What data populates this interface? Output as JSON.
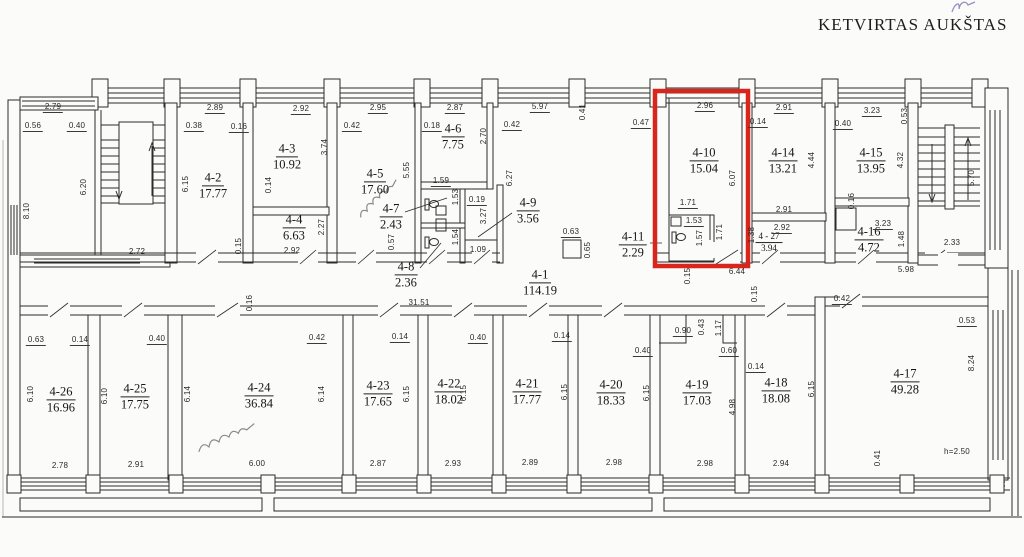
{
  "title": "KETVIRTAS AUKŠTAS",
  "highlight_color": "#d9261c",
  "rooms": {
    "r4_1": {
      "id": "4-1",
      "area": "114.19"
    },
    "r4_2": {
      "id": "4-2",
      "area": "17.77"
    },
    "r4_3": {
      "id": "4-3",
      "area": "10.92"
    },
    "r4_4": {
      "id": "4-4",
      "area": "6.63"
    },
    "r4_5": {
      "id": "4-5",
      "area": "17.60"
    },
    "r4_6": {
      "id": "4-6",
      "area": "7.75"
    },
    "r4_7": {
      "id": "4-7",
      "area": "2.43"
    },
    "r4_8": {
      "id": "4-8",
      "area": "2.36"
    },
    "r4_9": {
      "id": "4-9",
      "area": "3.56"
    },
    "r4_10": {
      "id": "4-10",
      "area": "15.04"
    },
    "r4_11": {
      "id": "4-11",
      "area": "2.29"
    },
    "r4_14": {
      "id": "4-14",
      "area": "13.21"
    },
    "r4_15": {
      "id": "4-15",
      "area": "13.95"
    },
    "r4_16": {
      "id": "4-16",
      "area": "4.72"
    },
    "r4_17": {
      "id": "4-17",
      "area": "49.28"
    },
    "r4_18": {
      "id": "4-18",
      "area": "18.08"
    },
    "r4_19": {
      "id": "4-19",
      "area": "17.03"
    },
    "r4_20": {
      "id": "4-20",
      "area": "18.33"
    },
    "r4_21": {
      "id": "4-21",
      "area": "17.77"
    },
    "r4_22": {
      "id": "4-22",
      "area": "18.02"
    },
    "r4_23": {
      "id": "4-23",
      "area": "17.65"
    },
    "r4_24": {
      "id": "4-24",
      "area": "36.84"
    },
    "r4_25": {
      "id": "4-25",
      "area": "17.75"
    },
    "r4_26": {
      "id": "4-26",
      "area": "16.96"
    },
    "r4_27": {
      "id": "4 - 27",
      "area": "3.94"
    }
  },
  "dims": {
    "sl_top": "2.79",
    "sl_a": "0.56",
    "sl_b": "0.40",
    "sl_h": "6.20",
    "ext_l": "8.10",
    "sl_bot": "2.72",
    "r2_top": "2.89",
    "r2_a": "0.38",
    "r2_b": "0.16",
    "r2_h": "6.15",
    "r2_c": "0.15",
    "r3_top": "2.92",
    "r3_h": "3.74",
    "r3_a": "0.14",
    "r4_h": "2.27",
    "r4_bot": "2.92",
    "r5_top": "2.95",
    "r5_a": "0.42",
    "r5_h": "5.55",
    "r5_b": "0.57",
    "r6_top": "2.87",
    "r6_a": "0.18",
    "r6_b": "0.42",
    "r6_h": "2.70",
    "hall_top": "5.97",
    "col_a": "0.41",
    "wc_a": "1.59",
    "wc_b": "1.53",
    "wc_c": "0.19",
    "wc_d": "3.27",
    "wc_e": "1.54",
    "wc_f": "1.09",
    "open_h": "6.27",
    "col2_w": "0.63",
    "col2_h": "0.65",
    "r10_top": "2.96",
    "r10_a": "0.47",
    "r10_b": "0.14",
    "r10_h": "6.07",
    "r10_c": "1.71",
    "r10_d": "1.53",
    "r10_e": "1.57",
    "r10_f": "1.71",
    "r10_g": "1.38",
    "r10_bot": "6.44",
    "r10_i": "0.15",
    "r10_j": "0.15",
    "r14_top": "2.91",
    "r14_h": "4.44",
    "r14_bot": "2.91",
    "r27_top": "2.92",
    "r15_top": "3.23",
    "r15_a": "0.40",
    "r15_b": "0.53",
    "r15_h": "4.32",
    "r15_c": "0.16",
    "r16_top": "3.23",
    "r16_h": "1.48",
    "sr_bot": "2.33",
    "sr_w": "5.98",
    "sr_h": "5.70",
    "hall_len": "31.51",
    "b26_a": "0.63",
    "b26_b": "0.14",
    "b25_a": "0.40",
    "b26_h": "6.10",
    "b25_h": "6.10",
    "b25_r": "6.14",
    "b24_t": "0.16",
    "b24_a": "0.42",
    "b24_r": "6.14",
    "b23_a": "0.14",
    "b23_r": "6.15",
    "b22_a": "0.40",
    "b22_r": "6.15",
    "b21_a": "0.14",
    "b21_r": "6.15",
    "b20_r": "6.15",
    "b19_a": "0.40",
    "b19_b": "0.90",
    "b19_c": "0.43",
    "b19_d": "1.17",
    "b19_e": "0.60",
    "b19_f": "0.14",
    "b19_h": "4.98",
    "b18_r": "6.15",
    "b17_a": "0.42",
    "b17_b": "0.53",
    "b17_h": "8.24",
    "b17_c": "0.41",
    "b17_note": "h=2.50",
    "b26_bot": "2.78",
    "b25_bot": "2.91",
    "b24_bot": "6.00",
    "b23_bot": "2.87",
    "b22_bot": "2.93",
    "b21_bot": "2.89",
    "b20_bot": "2.98",
    "b19_bot": "2.98",
    "b18_bot": "2.94"
  }
}
